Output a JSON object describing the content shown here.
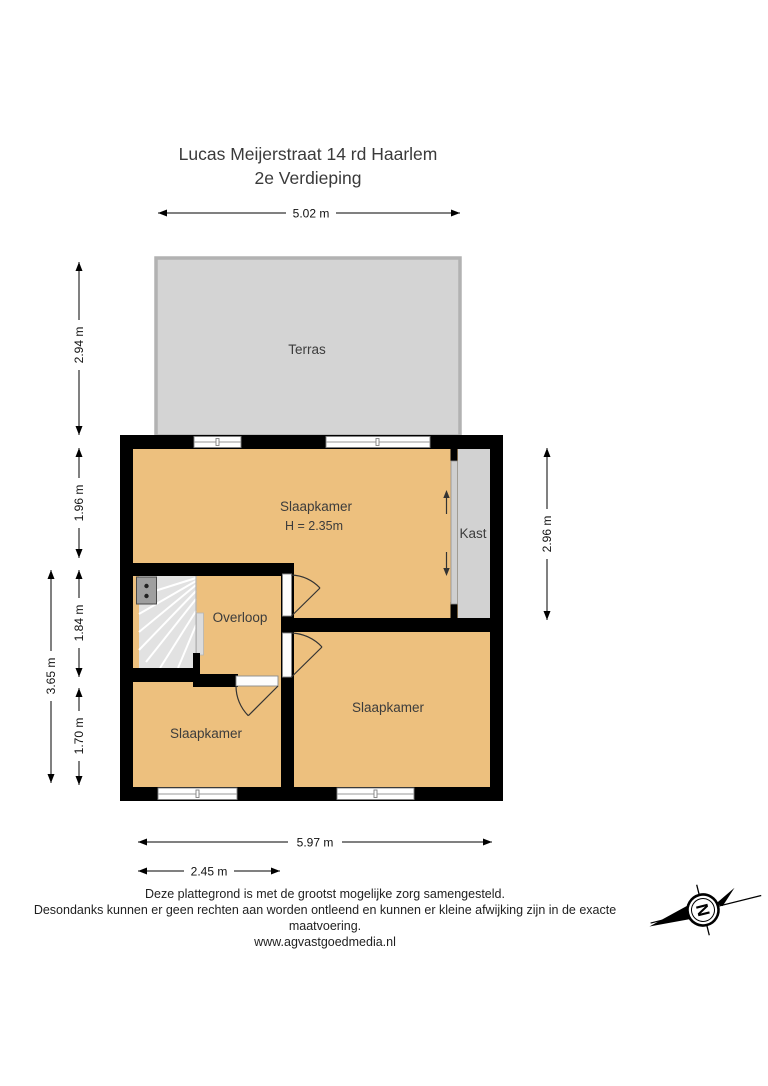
{
  "title": {
    "line1": "Lucas Meijerstraat 14 rd Haarlem",
    "line2": "2e Verdieping"
  },
  "rooms": {
    "terras": "Terras",
    "bedroom_top": {
      "name": "Slaapkamer",
      "ceiling_height": "H = 2.35m"
    },
    "closet": "Kast",
    "landing": "Overloop",
    "bedroom_left": "Slaapkamer",
    "bedroom_right": "Slaapkamer"
  },
  "dimensions": {
    "top_width": "5.02 m",
    "terrace_depth": "2.94 m",
    "bedroom_top_depth": "1.96 m",
    "landing_depth": "1.84 m",
    "bedroom_left_depth": "1.70 m",
    "left_total_depth": "3.65 m",
    "closet_side_height": "2.96 m",
    "bottom_width": "5.97 m",
    "bottom_left_width": "2.45 m"
  },
  "footer": {
    "line1": "Deze plattegrond is met de grootst mogelijke zorg samengesteld.",
    "line2": "Desondanks kunnen er geen rechten aan worden ontleend en kunnen er kleine afwijking zijn in de exacte maatvoering.",
    "line3": "www.agvastgoedmedia.nl"
  },
  "compass": {
    "north_letter": "N"
  },
  "colors": {
    "room_fill": "#edc07e",
    "terrace_fill": "#d4d4d4",
    "closet_fill": "#d2d2d2",
    "stairs_fill": "#e2e2e2",
    "wall": "#000000"
  }
}
